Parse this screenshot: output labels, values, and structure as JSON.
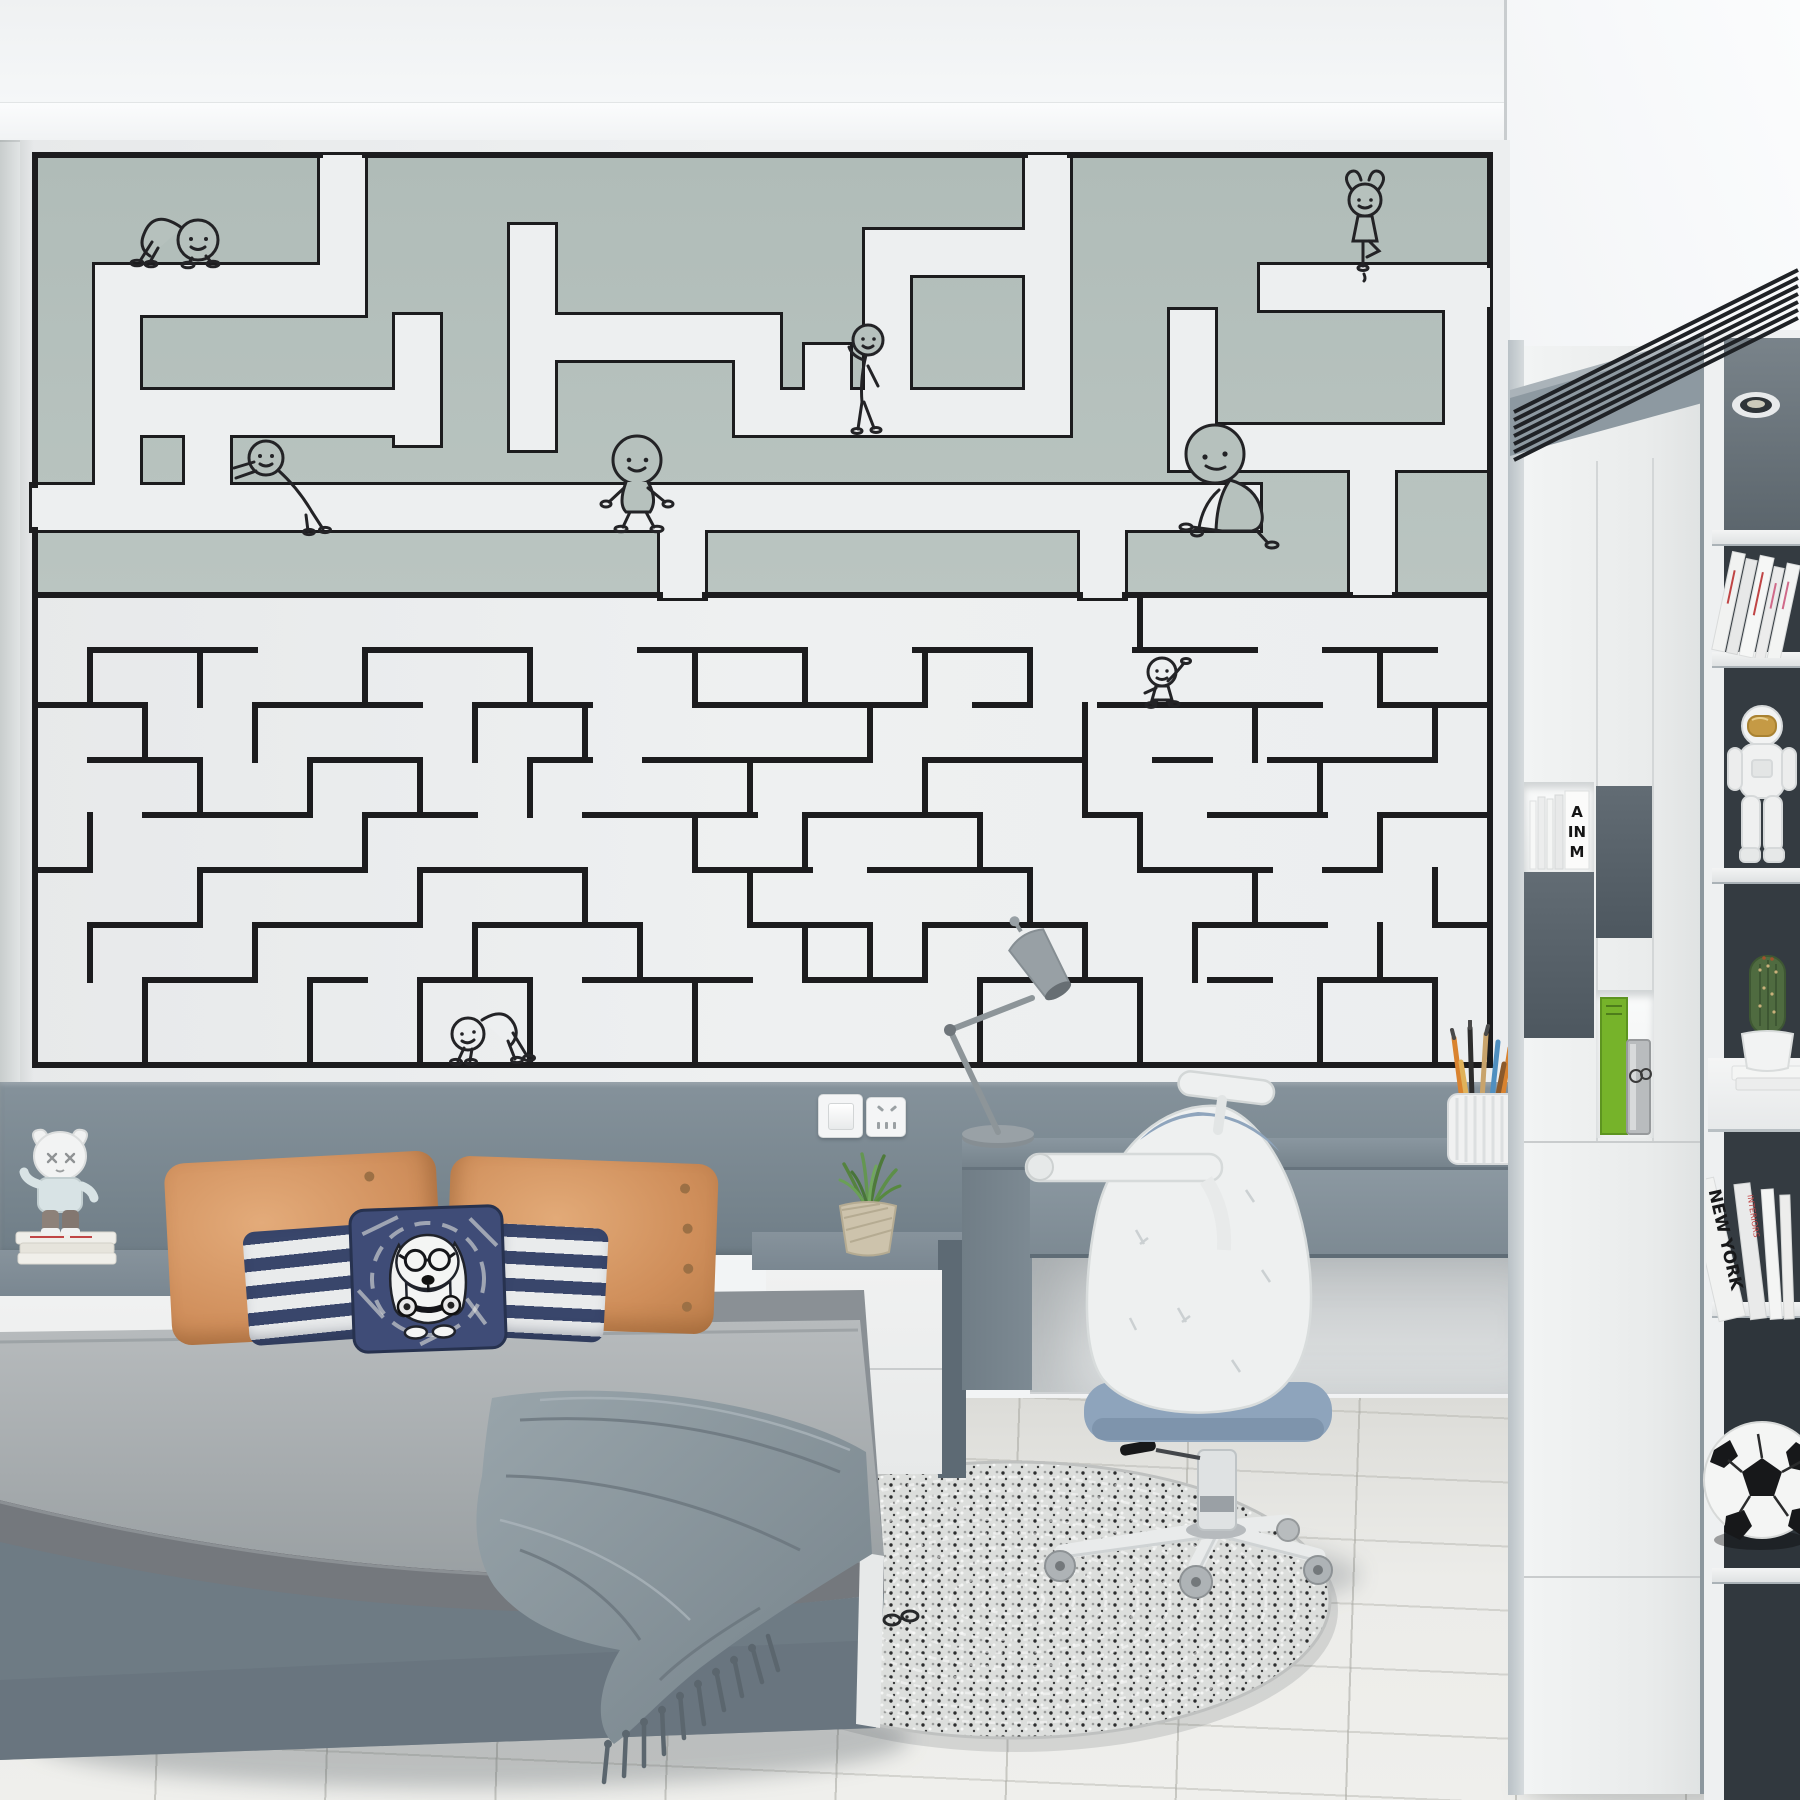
{
  "palette": {
    "maze_upper_bg": "#b6c1bd",
    "maze_lower_bg": "#edeff0",
    "maze_line": "#1c1c1e",
    "headboard_panel": "#7e8b94",
    "bed_base": "#6e7b84",
    "blanket": "#8c98a0",
    "pillow_orange": "#d89a69",
    "pillow_navy": "#3f4c77",
    "stripe_navy": "#39466b",
    "furniture_gray": "#7e8b93",
    "furniture_white": "#eff1f1",
    "shelf_interior": "#343b41",
    "chair_blue": "#8fa5bd",
    "floor": "#e9e9e6",
    "book_green": "#76b32a"
  },
  "mural": {
    "style": "maze wallpaper with stick figures",
    "figures": [
      {
        "pose": "crawling"
      },
      {
        "pose": "pushing-wall"
      },
      {
        "pose": "walking"
      },
      {
        "pose": "leaning-on-ledge"
      },
      {
        "pose": "tree-pose"
      },
      {
        "pose": "sitting-on-wall"
      },
      {
        "pose": "waving"
      },
      {
        "pose": "crawl-stretch"
      }
    ]
  },
  "books": {
    "cubby_spine_letters": [
      "A",
      "IN",
      "M"
    ],
    "shelf_spine_title": "NEW YORK",
    "shelf_spine_red_title": "INTERIORS"
  },
  "objects": [
    "toy-figurine",
    "book-stack",
    "wall-switch",
    "wall-outlet",
    "desk-lamp",
    "pencil-cup",
    "potted-grass-plant",
    "ergonomic-chair",
    "round-braided-rug",
    "astronaut-figurine",
    "cactus-pot",
    "soccer-ball",
    "air-vent",
    "downlight",
    "dog-print-pillow",
    "throw-blanket"
  ]
}
